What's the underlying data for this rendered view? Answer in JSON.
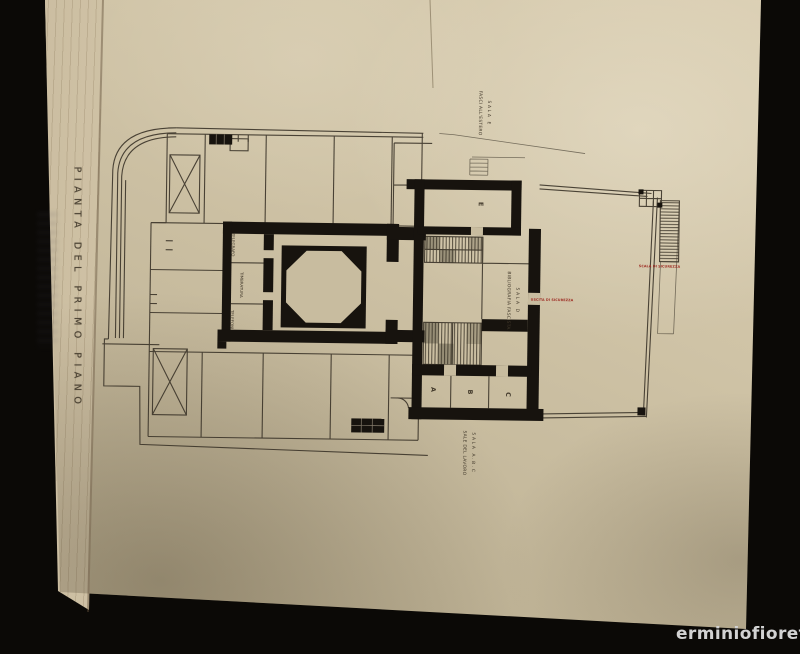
{
  "photo": {
    "watermark_text": "erminiofioretti"
  },
  "plate_title": "PIANTA DEL PRIMO PIANO",
  "plan_labels": {
    "sala_e_line1": "SALA E",
    "sala_e_line2": "FASCI ALL'ESTERO",
    "sala_d_line1": "SALA D",
    "sala_d_line2": "BIBLIOGRAFIA FASCISTA",
    "sala_abc_line1": "SALA A.B.C",
    "sala_abc_line2": "SALE DEL LAVORO",
    "telegrafo": "TELEGRAFO",
    "timbratura": "TIMBRATURA",
    "telefoni": "TELEFONI",
    "letter_e": "E",
    "letter_a": "A",
    "letter_b": "B",
    "letter_c": "C",
    "red_exit": "USCITA DI SICUREZZA",
    "red_stair": "SCALA DI SICUREZZA"
  },
  "colors": {
    "background": "#0b0906",
    "paper": "#cbbfa2",
    "paper_edge": "#d9cdb2",
    "ink": "#3b3429",
    "wall": "#17130e",
    "red_ink": "#9e2d24",
    "watermark": "#d2d2d2"
  }
}
